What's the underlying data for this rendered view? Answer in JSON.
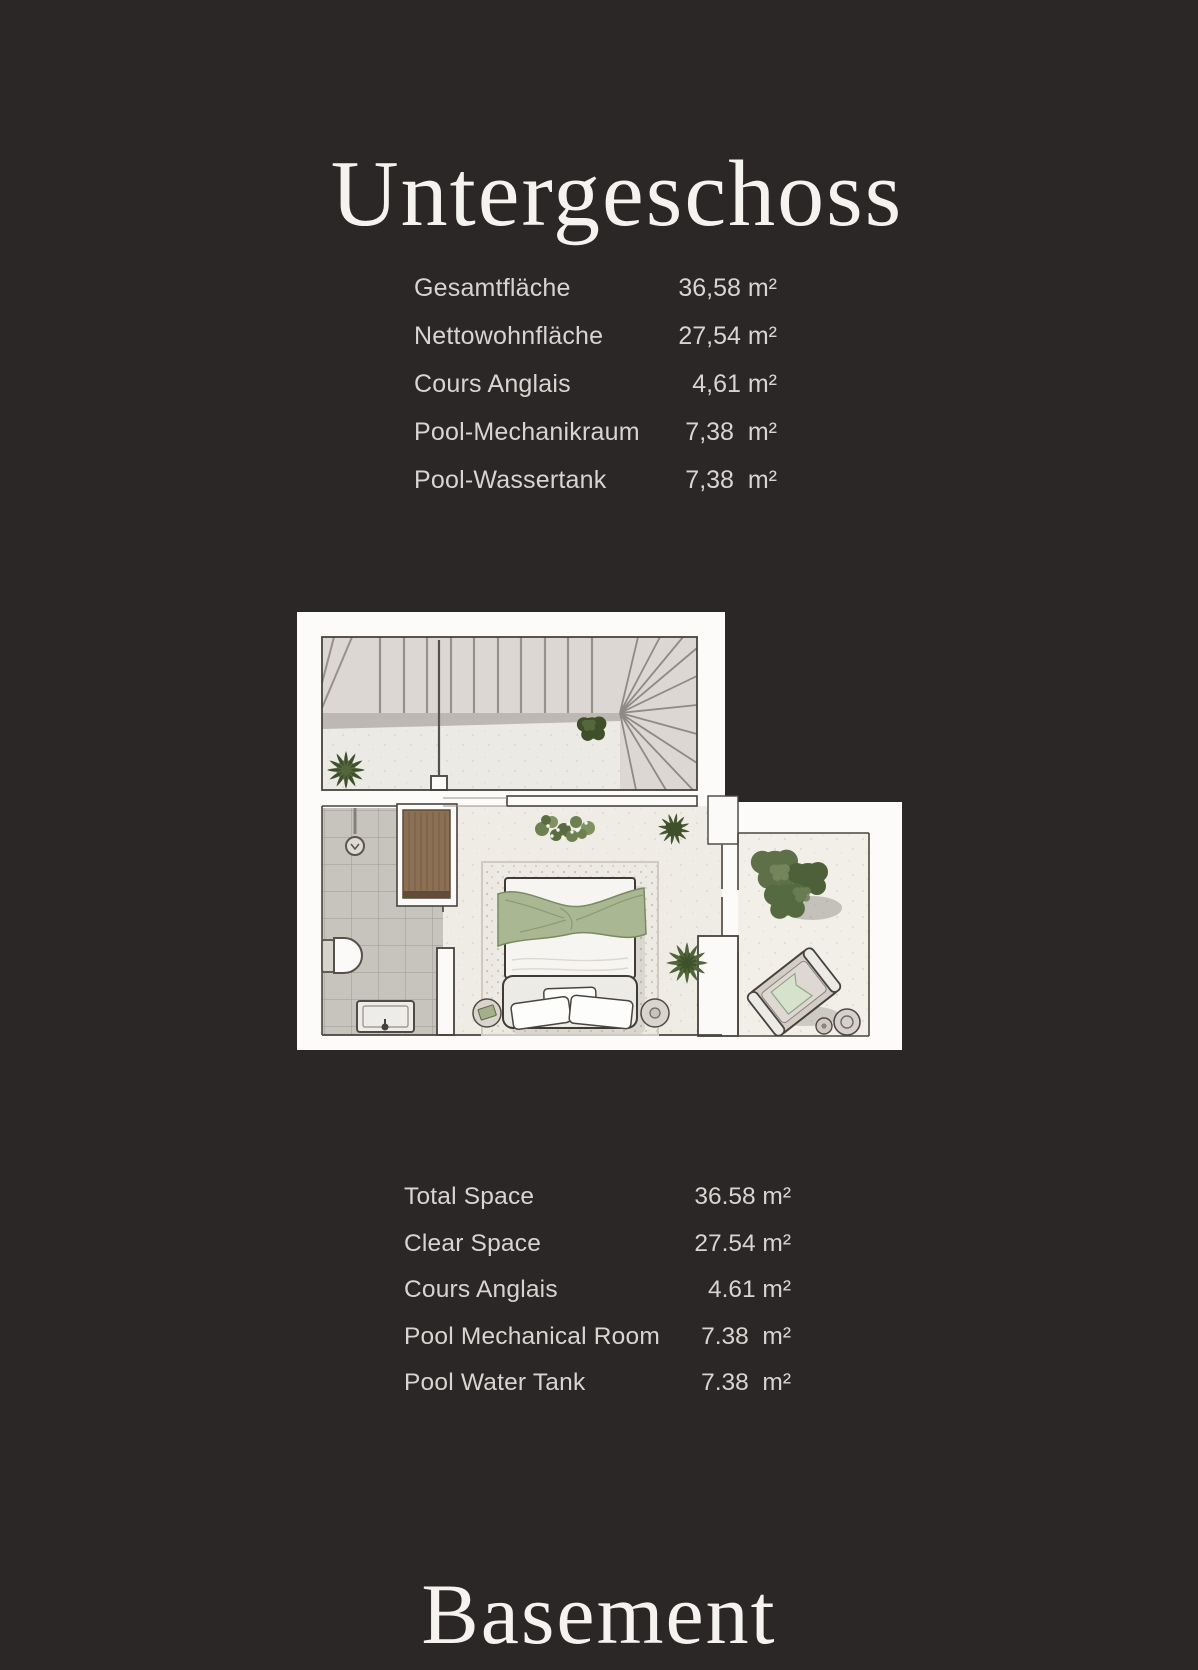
{
  "page": {
    "title_de": "Untergeschoss",
    "title_en": "Basement",
    "background_color": "#2a2726",
    "text_color": "#d7d5d2"
  },
  "tables": {
    "german": {
      "rows": [
        {
          "label": "Gesamtfläche",
          "value": "36,58 m²"
        },
        {
          "label": "Nettowohnfläche",
          "value": "27,54 m²"
        },
        {
          "label": "Cours Anglais",
          "value": "4,61 m²"
        },
        {
          "label": "Pool-Mechanikraum",
          "value": "7,38  m²"
        },
        {
          "label": "Pool-Wassertank",
          "value": "7,38  m²"
        }
      ]
    },
    "english": {
      "rows": [
        {
          "label": "Total Space",
          "value": "36.58 m²"
        },
        {
          "label": "Clear Space",
          "value": "27.54 m²"
        },
        {
          "label": "Cours Anglais",
          "value": "4.61 m²"
        },
        {
          "label": "Pool Mechanical Room",
          "value": "7.38  m²"
        },
        {
          "label": "Pool Water Tank",
          "value": "7.38  m²"
        }
      ]
    }
  },
  "floor_plan": {
    "kind": "illustrated basement floor plan, top-down view",
    "rooms": [
      "staircase-hall",
      "bathroom",
      "bedroom",
      "cours-anglais-patio"
    ],
    "furniture": [
      "staircase",
      "shower",
      "toilet",
      "sink",
      "wooden-wardrobe",
      "double-bed-with-sage-blanket",
      "pillows",
      "nightstand-left",
      "nightstand-right",
      "rug",
      "lounge-chair-with-towel",
      "side-tables",
      "plants",
      "large-bush"
    ],
    "colors": {
      "card": "#fcfbf9",
      "floor": "#efece6",
      "stairs": "#dcd7d2",
      "tiles": "#c7c3bd",
      "wood": "#8b7053",
      "blanket": "#a9b893",
      "plant_dark": "#45572f",
      "plant_mid": "#55683f"
    }
  }
}
